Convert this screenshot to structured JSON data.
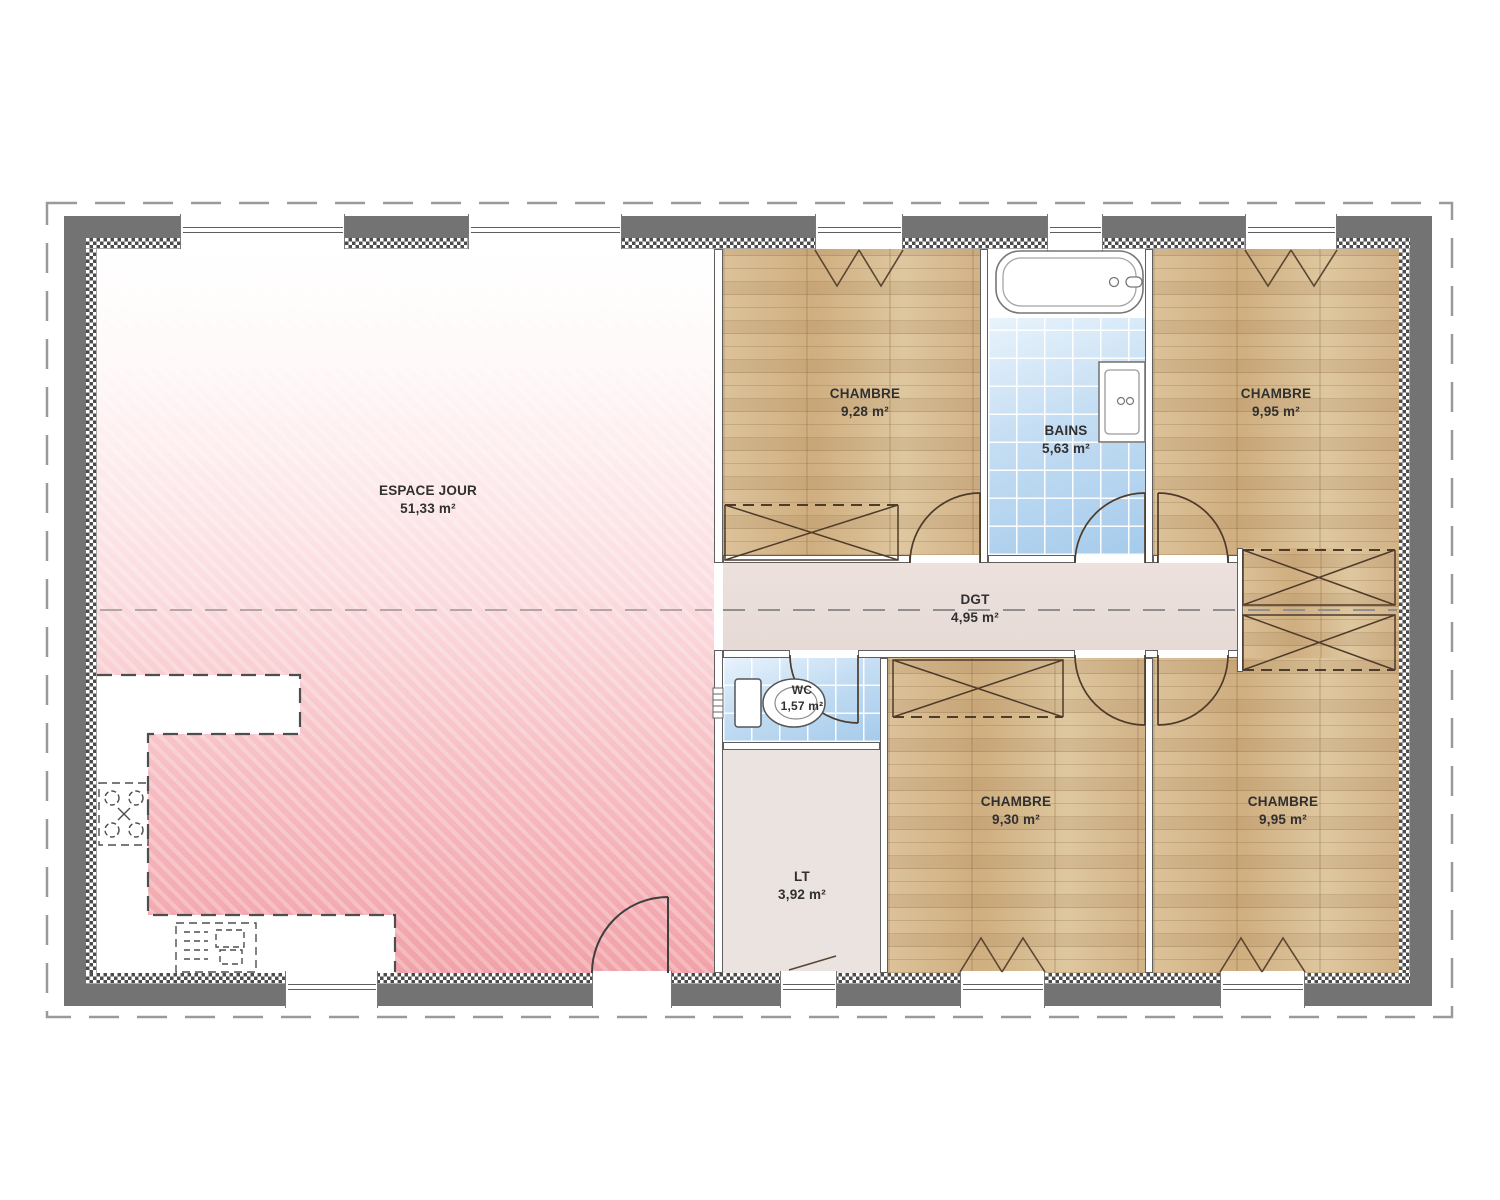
{
  "plan": {
    "type": "floor-plan",
    "rooms": [
      {
        "id": "espace-jour",
        "name": "ESPACE JOUR",
        "area": "51,33 m²"
      },
      {
        "id": "chambre-1",
        "name": "CHAMBRE",
        "area": "9,28 m²"
      },
      {
        "id": "bains",
        "name": "BAINS",
        "area": "5,63 m²"
      },
      {
        "id": "chambre-2",
        "name": "CHAMBRE",
        "area": "9,95 m²"
      },
      {
        "id": "degagement",
        "name": "DGT",
        "area": "4,95 m²"
      },
      {
        "id": "wc",
        "name": "WC",
        "area": "1,57 m²"
      },
      {
        "id": "lingerie",
        "name": "LT",
        "area": "3,92 m²"
      },
      {
        "id": "chambre-3",
        "name": "CHAMBRE",
        "area": "9,30 m²"
      },
      {
        "id": "chambre-4",
        "name": "CHAMBRE",
        "area": "9,95 m²"
      }
    ],
    "colors": {
      "exterior_wall": "#737373",
      "wood_floor": "#d7bb90",
      "tile_floor": "#b9d7f0",
      "living_floor": "#f1a2a8",
      "corridor_floor": "#e8dcd8",
      "laundry_floor": "#eae3e0"
    }
  }
}
